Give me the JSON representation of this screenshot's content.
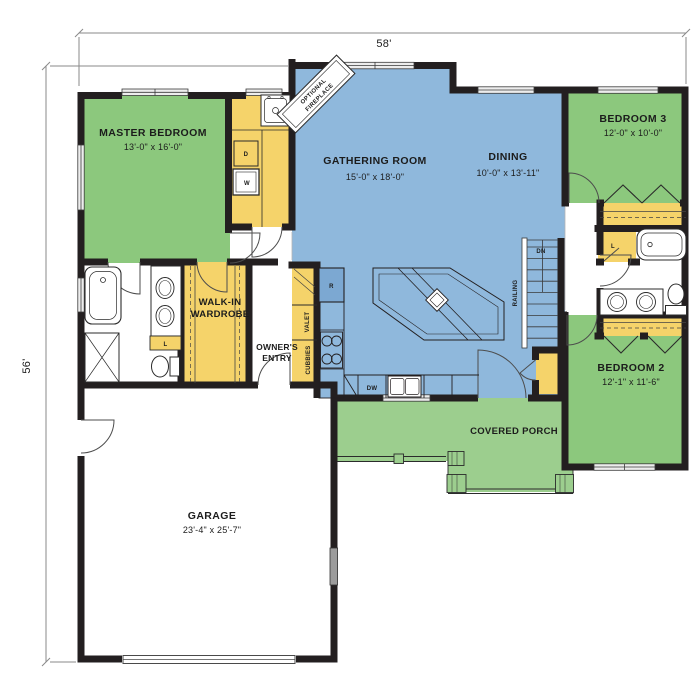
{
  "dimensions": {
    "width_label": "58'",
    "height_label": "56'"
  },
  "rooms": {
    "master_bedroom": {
      "name": "MASTER BEDROOM",
      "size": "13'-0\" x 16'-0\""
    },
    "gathering_room": {
      "name": "GATHERING ROOM",
      "size": "15'-0\" x 18'-0\""
    },
    "dining": {
      "name": "DINING",
      "size": "10'-0\" x 13'-11\""
    },
    "bedroom_3": {
      "name": "BEDROOM 3",
      "size": "12'-0\" x 10'-0\""
    },
    "bedroom_2": {
      "name": "BEDROOM 2",
      "size": "12'-1\" x 11'-6\""
    },
    "garage": {
      "name": "GARAGE",
      "size": "23'-4\" x 25'-7\""
    },
    "covered_porch": {
      "name": "COVERED PORCH"
    },
    "walk_in_wardrobe": {
      "line1": "WALK-IN",
      "line2": "WARDROBE"
    },
    "owners_entry": {
      "line1": "OWNER'S",
      "line2": "ENTRY"
    }
  },
  "annotations": {
    "optional_fireplace": {
      "line1": "OPTIONAL",
      "line2": "FIREPLACE"
    },
    "railing": "RAILING",
    "down": "DN",
    "dishwasher": "DW",
    "dryer": "D",
    "washer": "W",
    "refrigerator": "R",
    "linen": "L",
    "valet": "VALET",
    "cubbies": "CUBBIES"
  },
  "colors": {
    "bedroom_green": "#8CC87D",
    "living_blue": "#8FB8DC",
    "cabinet_yellow": "#F5D36A",
    "wall_black": "#231F20",
    "porch_green": "#9CCE8E"
  }
}
